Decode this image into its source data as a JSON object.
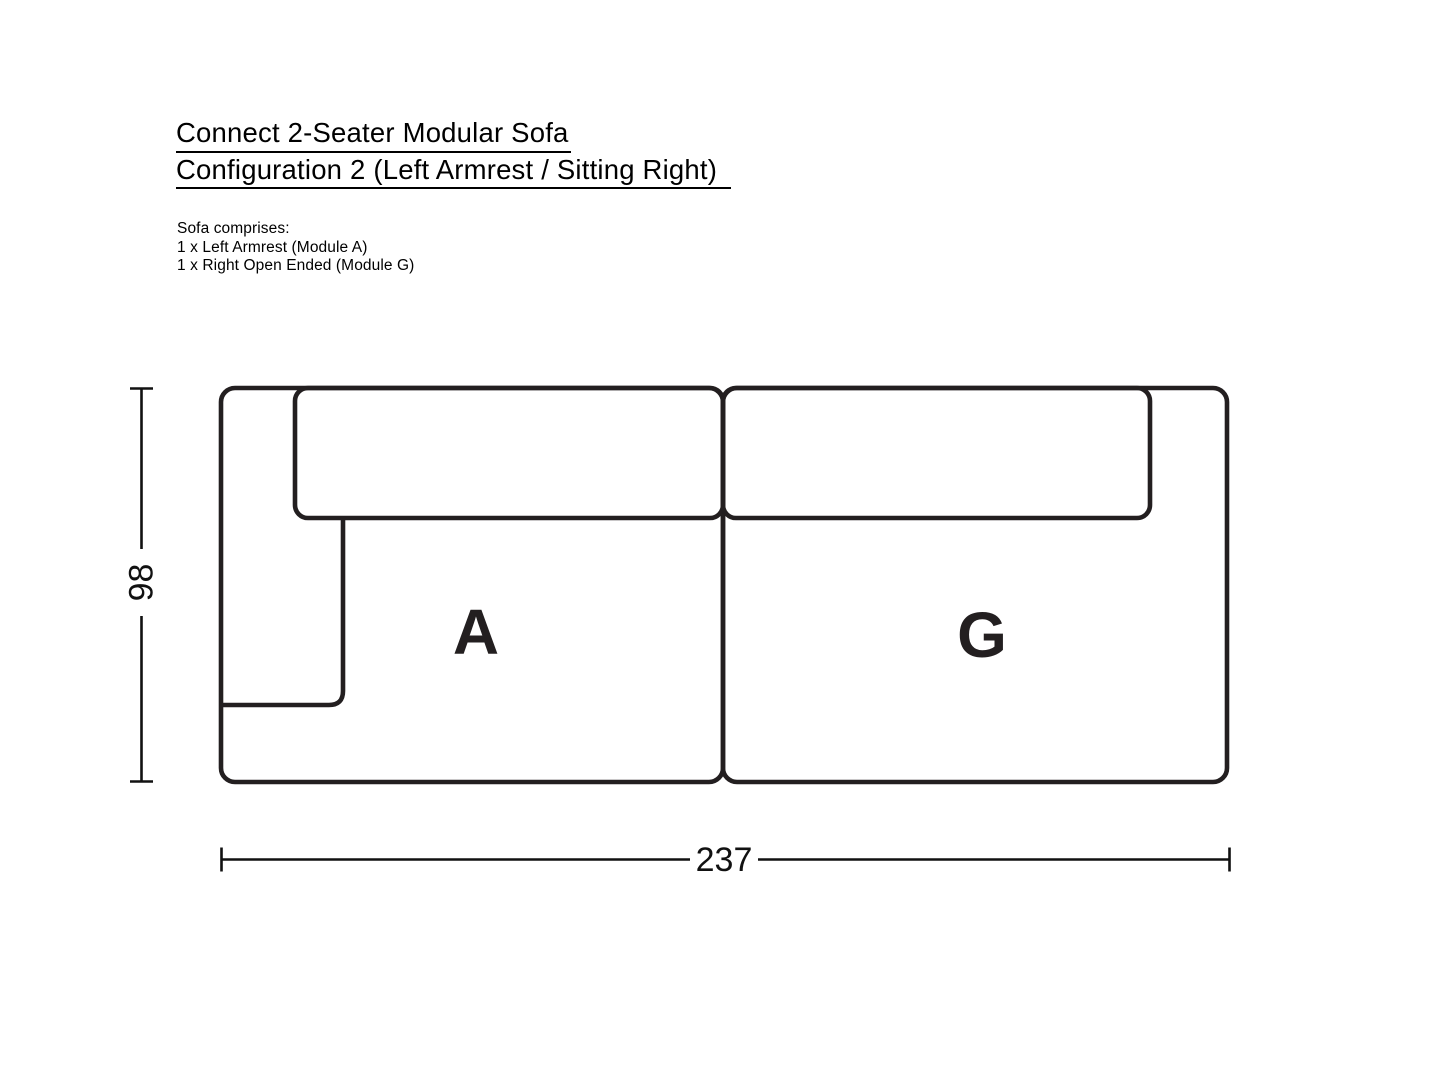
{
  "header": {
    "title_line1": "Connect 2-Seater Modular Sofa",
    "title_line2": "Configuration 2 (Left Armrest / Sitting Right)",
    "comprises": {
      "heading": "Sofa comprises:",
      "items": [
        "1 x Left Armrest (Module A)",
        "1 x Right Open Ended (Module G)"
      ]
    }
  },
  "diagram": {
    "modules": [
      {
        "label": "A"
      },
      {
        "label": "G"
      }
    ],
    "dimensions": {
      "height": "98",
      "width": "237"
    }
  },
  "colors": {
    "sofa_line": "#231f20",
    "dimension_line": "#111111",
    "label_text": "#231f20",
    "heading_text": "#000000"
  }
}
